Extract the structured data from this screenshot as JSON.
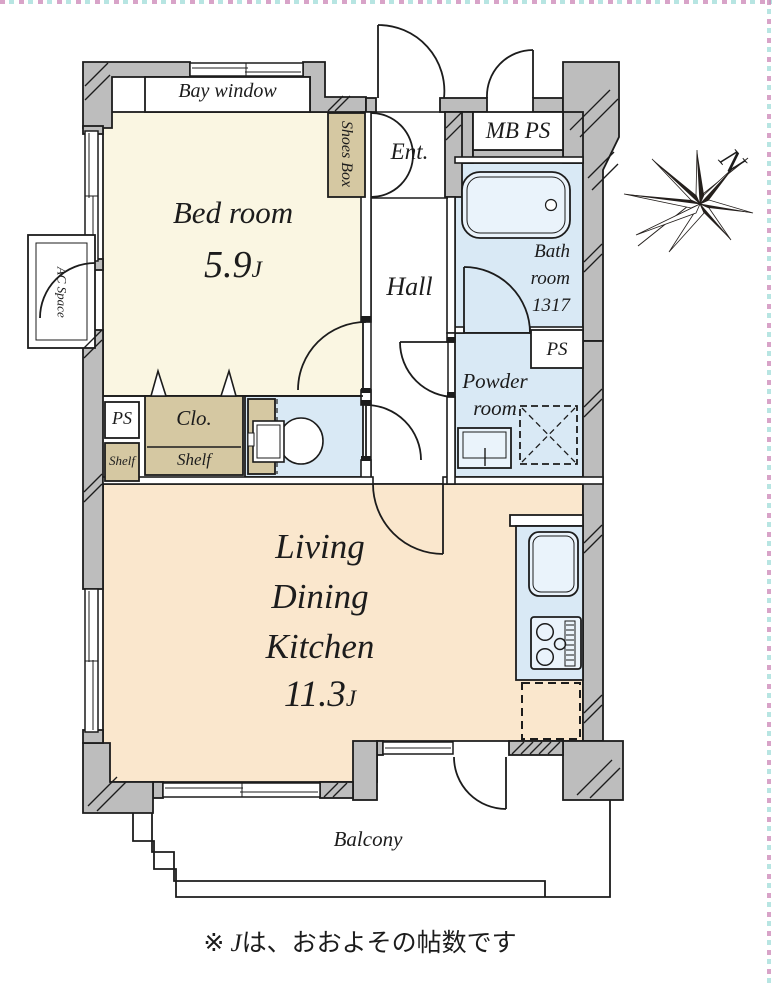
{
  "palette": {
    "bedroom": "#faf6e2",
    "ldk": "#fae7cd",
    "wet": "#d9e9f5",
    "fixture": "#eaf3fb",
    "tan": "#d5c8a2",
    "wall": "#bdbdbd"
  },
  "labels": {
    "bay_window": "Bay window",
    "bedroom_name": "Bed room",
    "bedroom_size": "5.9",
    "bedroom_unit": "J",
    "shoes_box": "Shoes Box",
    "entrance": "Ent.",
    "hall": "Hall",
    "mb_ps": "MB PS",
    "bath_line1": "Bath",
    "bath_line2": "room",
    "bath_line3": "1317",
    "ps_bath": "PS",
    "powder_line1": "Powder",
    "powder_line2": "room",
    "ps_left": "PS",
    "shelf_small": "Shelf",
    "closet": "Clo.",
    "closet_shelf": "Shelf",
    "ac_space": "AC Space",
    "ldk_line1": "Living",
    "ldk_line2": "Dining",
    "ldk_line3": "Kitchen",
    "ldk_size": "11.3",
    "ldk_unit": "J",
    "balcony": "Balcony",
    "compass_north": "N",
    "footnote_prefix": "※ ",
    "footnote_j": "J",
    "footnote_text": "は、おおよその帖数です"
  }
}
